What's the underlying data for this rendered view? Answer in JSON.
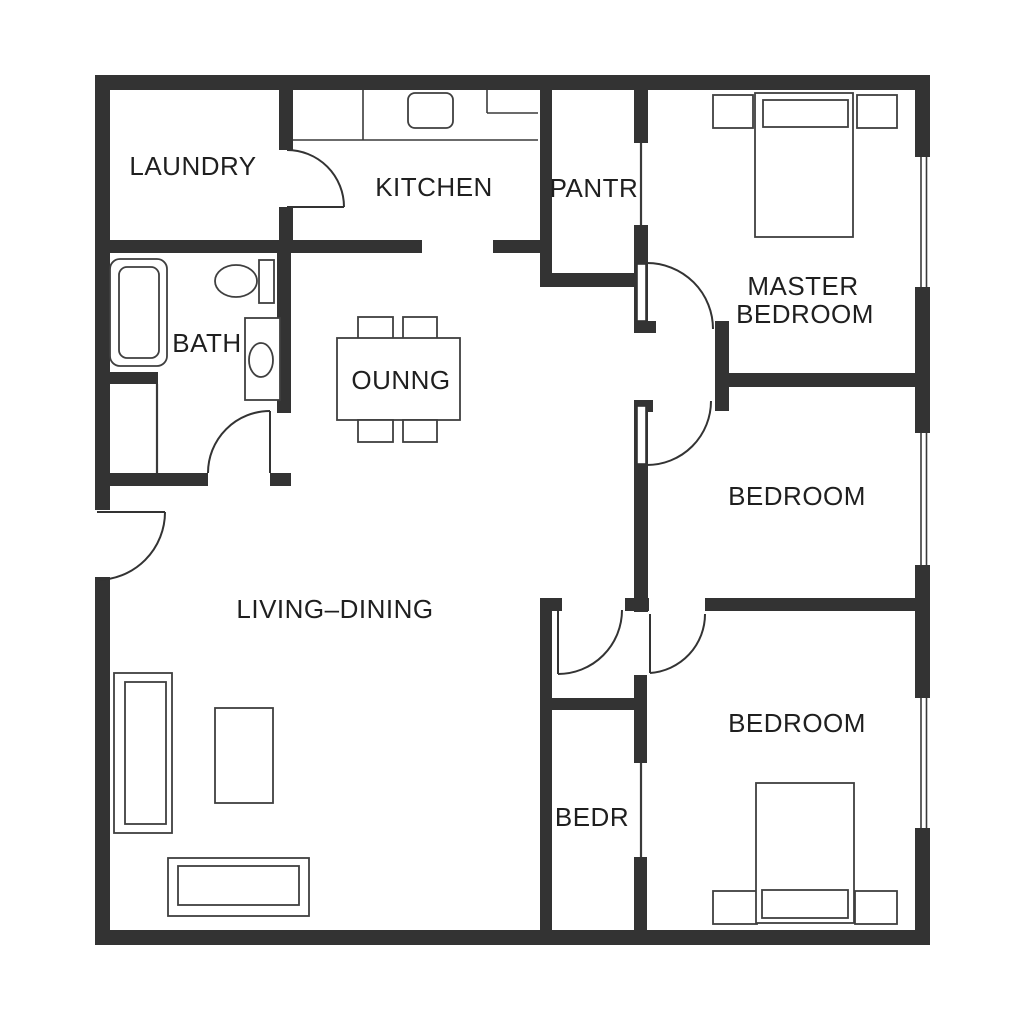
{
  "plan": {
    "type": "residential-floor-plan",
    "background_color": "#ffffff",
    "wall_color": "#333333",
    "text_color": "#1f1f1f",
    "rooms": [
      {
        "id": "laundry",
        "label": "LAUNDRY"
      },
      {
        "id": "kitchen",
        "label": "KITCHEN"
      },
      {
        "id": "pantry",
        "label": "PANTR"
      },
      {
        "id": "master_bedroom",
        "label_line1": "MASTER",
        "label_line2": "BEDROOM"
      },
      {
        "id": "bath",
        "label": "BATH"
      },
      {
        "id": "dining_nook",
        "label": "OUNNG"
      },
      {
        "id": "bedroom_middle",
        "label": "BEDROOM"
      },
      {
        "id": "living_dining",
        "label": "LIVING–DINING"
      },
      {
        "id": "bedroom_small",
        "label": "BEDR"
      },
      {
        "id": "bedroom_bottom",
        "label": "BEDROOM"
      }
    ],
    "symbols": [
      "kitchen-counter",
      "stove-icon",
      "cabinet-icon",
      "bathtub-icon",
      "toilet-icon",
      "sink-icon",
      "dining-table-icon",
      "chair-icon",
      "sofa-icon",
      "armchair-icon",
      "bed-icon",
      "nightstand-icon",
      "door-swing-icon",
      "window-icon"
    ]
  }
}
